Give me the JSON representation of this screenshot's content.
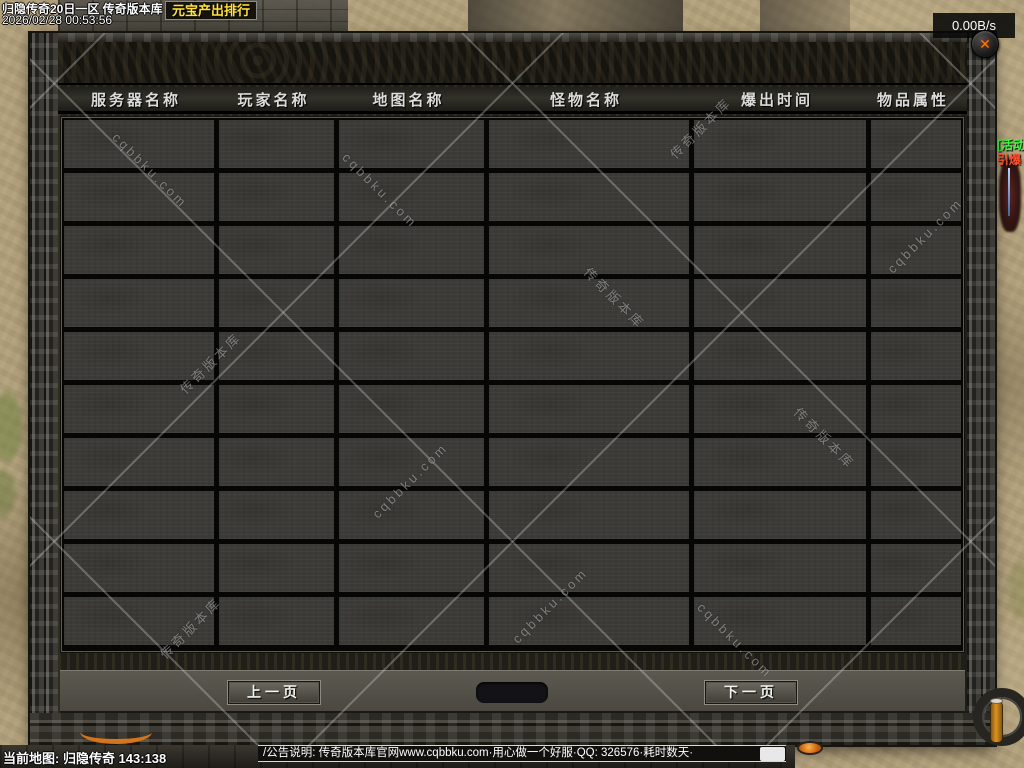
{
  "overlay": {
    "server_title": "归隐传奇20日一区 传奇版本库",
    "gold_rank_label": "元宝产出排行",
    "clock": "2026/02/28 00:53:56",
    "net_speed": "0.00B/s",
    "close_icon": "✕"
  },
  "panel": {
    "columns": [
      "服务器名称",
      "玩家名称",
      "地图名称",
      "怪物名称",
      "爆出时间",
      "物品属性"
    ],
    "rows": 10,
    "pagination": {
      "prev_label": "上一页",
      "next_label": "下一页",
      "page_indicator": ""
    }
  },
  "watermark": {
    "text_domain": "cqbbku.com",
    "text_cn": "传奇版本库"
  },
  "npc": {
    "activity_tag": "[活动]",
    "name": "引爆"
  },
  "bottom": {
    "map_info": "当前地图: 归隐传奇 143:138",
    "announcement": "/公告说明: 传奇版本库官网www.cqbbku.com·用心做一个好服·QQ: 326576·耗时数天·"
  },
  "colors": {
    "gold_text": "#ffe13a",
    "header_text": "#dcdcda",
    "close_x": "#ff7a00",
    "npc_activity_green": "#3dff3d",
    "npc_name_red": "#ff5030",
    "panel_cell": "#3c3b37",
    "ground_tan": "#b2a07a"
  }
}
